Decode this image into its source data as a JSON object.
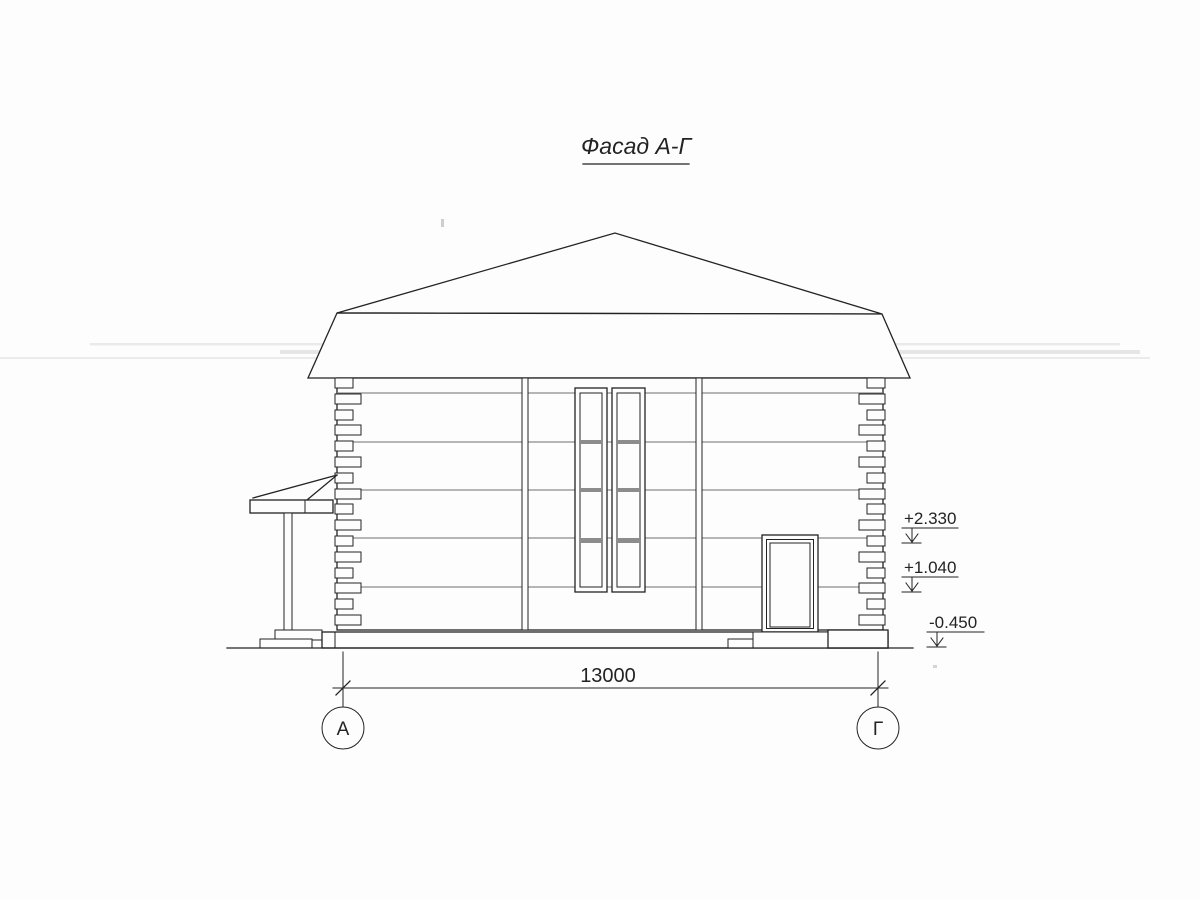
{
  "drawing": {
    "title": "Фасад А-Г",
    "dimension_label": "13000",
    "axis_left": "А",
    "axis_right": "Г",
    "elevation_marks": {
      "upper": "+2.330",
      "middle": "+1.040",
      "lower": "-0.450"
    },
    "colors": {
      "paper": "#fdfdfd",
      "ink": "#232323",
      "course": "#6e6e6e",
      "muntin": "#8c8c8c"
    }
  }
}
